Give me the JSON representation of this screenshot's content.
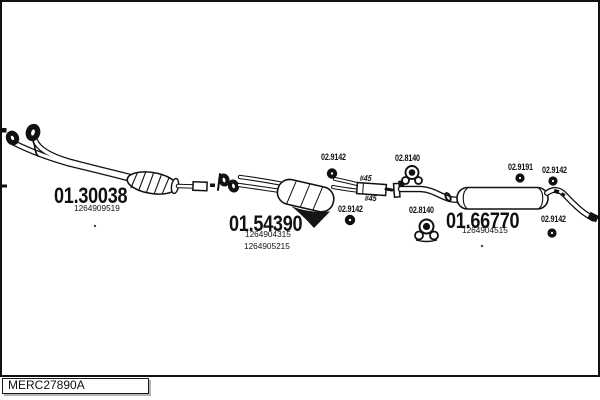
{
  "diagram": {
    "footer_code": "MERC27890A",
    "parts": [
      {
        "name": "front-pipe",
        "part_number": "01.30038",
        "oem_refs": [
          "1264909519"
        ]
      },
      {
        "name": "center-muffler",
        "part_number": "01.54390",
        "oem_refs": [
          "1264904315",
          "1264905215"
        ]
      },
      {
        "name": "rear-muffler",
        "part_number": "01.66770",
        "oem_refs": [
          "1264904515"
        ]
      }
    ],
    "fitting_labels": [
      {
        "name": "rubber-ring-top-center",
        "code": "02.9142"
      },
      {
        "name": "clamp-diameter-top",
        "code": "#45"
      },
      {
        "name": "clamp-diameter-bottom",
        "code": "#45"
      },
      {
        "name": "rubber-ring-bottom-center",
        "code": "02.9142"
      },
      {
        "name": "hanger-top",
        "code": "02.8140"
      },
      {
        "name": "hanger-bottom",
        "code": "02.8140"
      },
      {
        "name": "rubber-ring-9191",
        "code": "02.9191"
      },
      {
        "name": "rubber-ring-top-right",
        "code": "02.9142"
      },
      {
        "name": "rubber-ring-bottom-right",
        "code": "02.9142"
      }
    ],
    "colors": {
      "ink": "#111111",
      "paper": "#ffffff"
    }
  }
}
